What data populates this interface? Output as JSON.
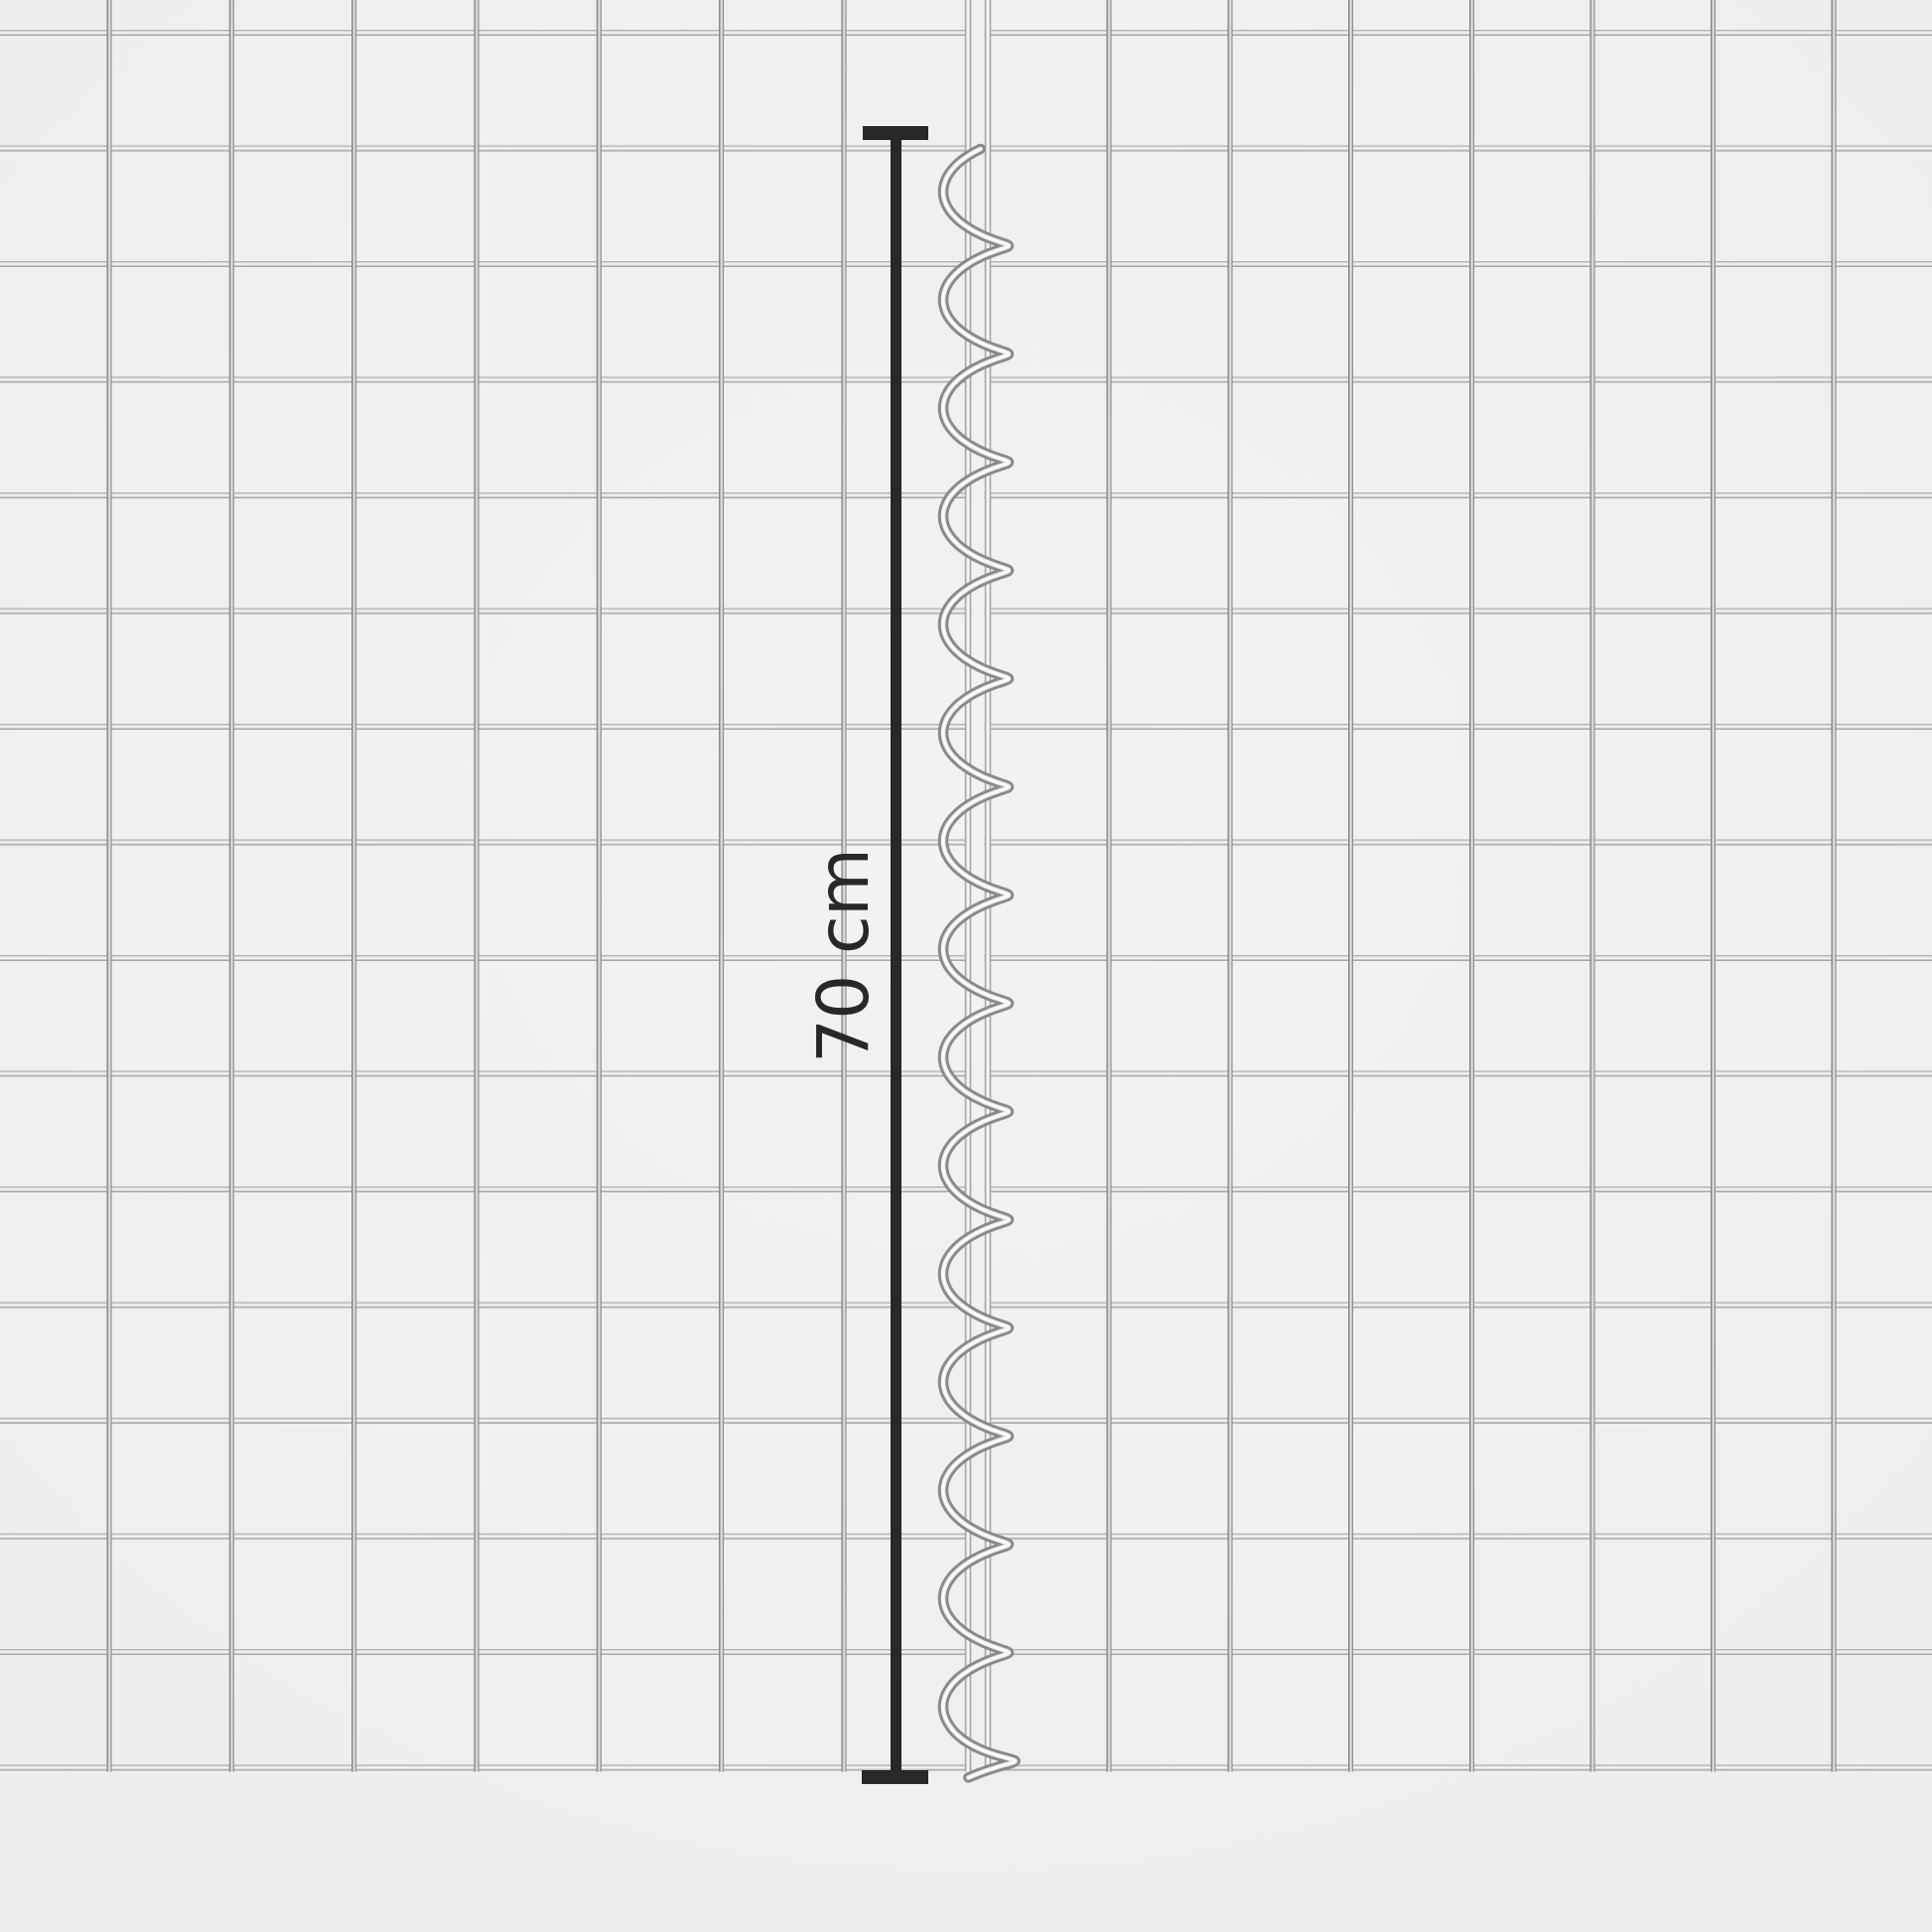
{
  "annotation": {
    "label": "70 cm"
  },
  "colors": {
    "background": "#ededed",
    "dimension_marker": "#282828",
    "wire_bright": "#f7f7f7",
    "wire_shade": "#8a8a8a",
    "spiral_core": "#ededed",
    "spiral_highlight": "#ffffff"
  },
  "mesh": {
    "panels": 2,
    "horizontal_wires": 16,
    "left_panel_vertical_wires": 8,
    "right_panel_vertical_wires": 8
  }
}
